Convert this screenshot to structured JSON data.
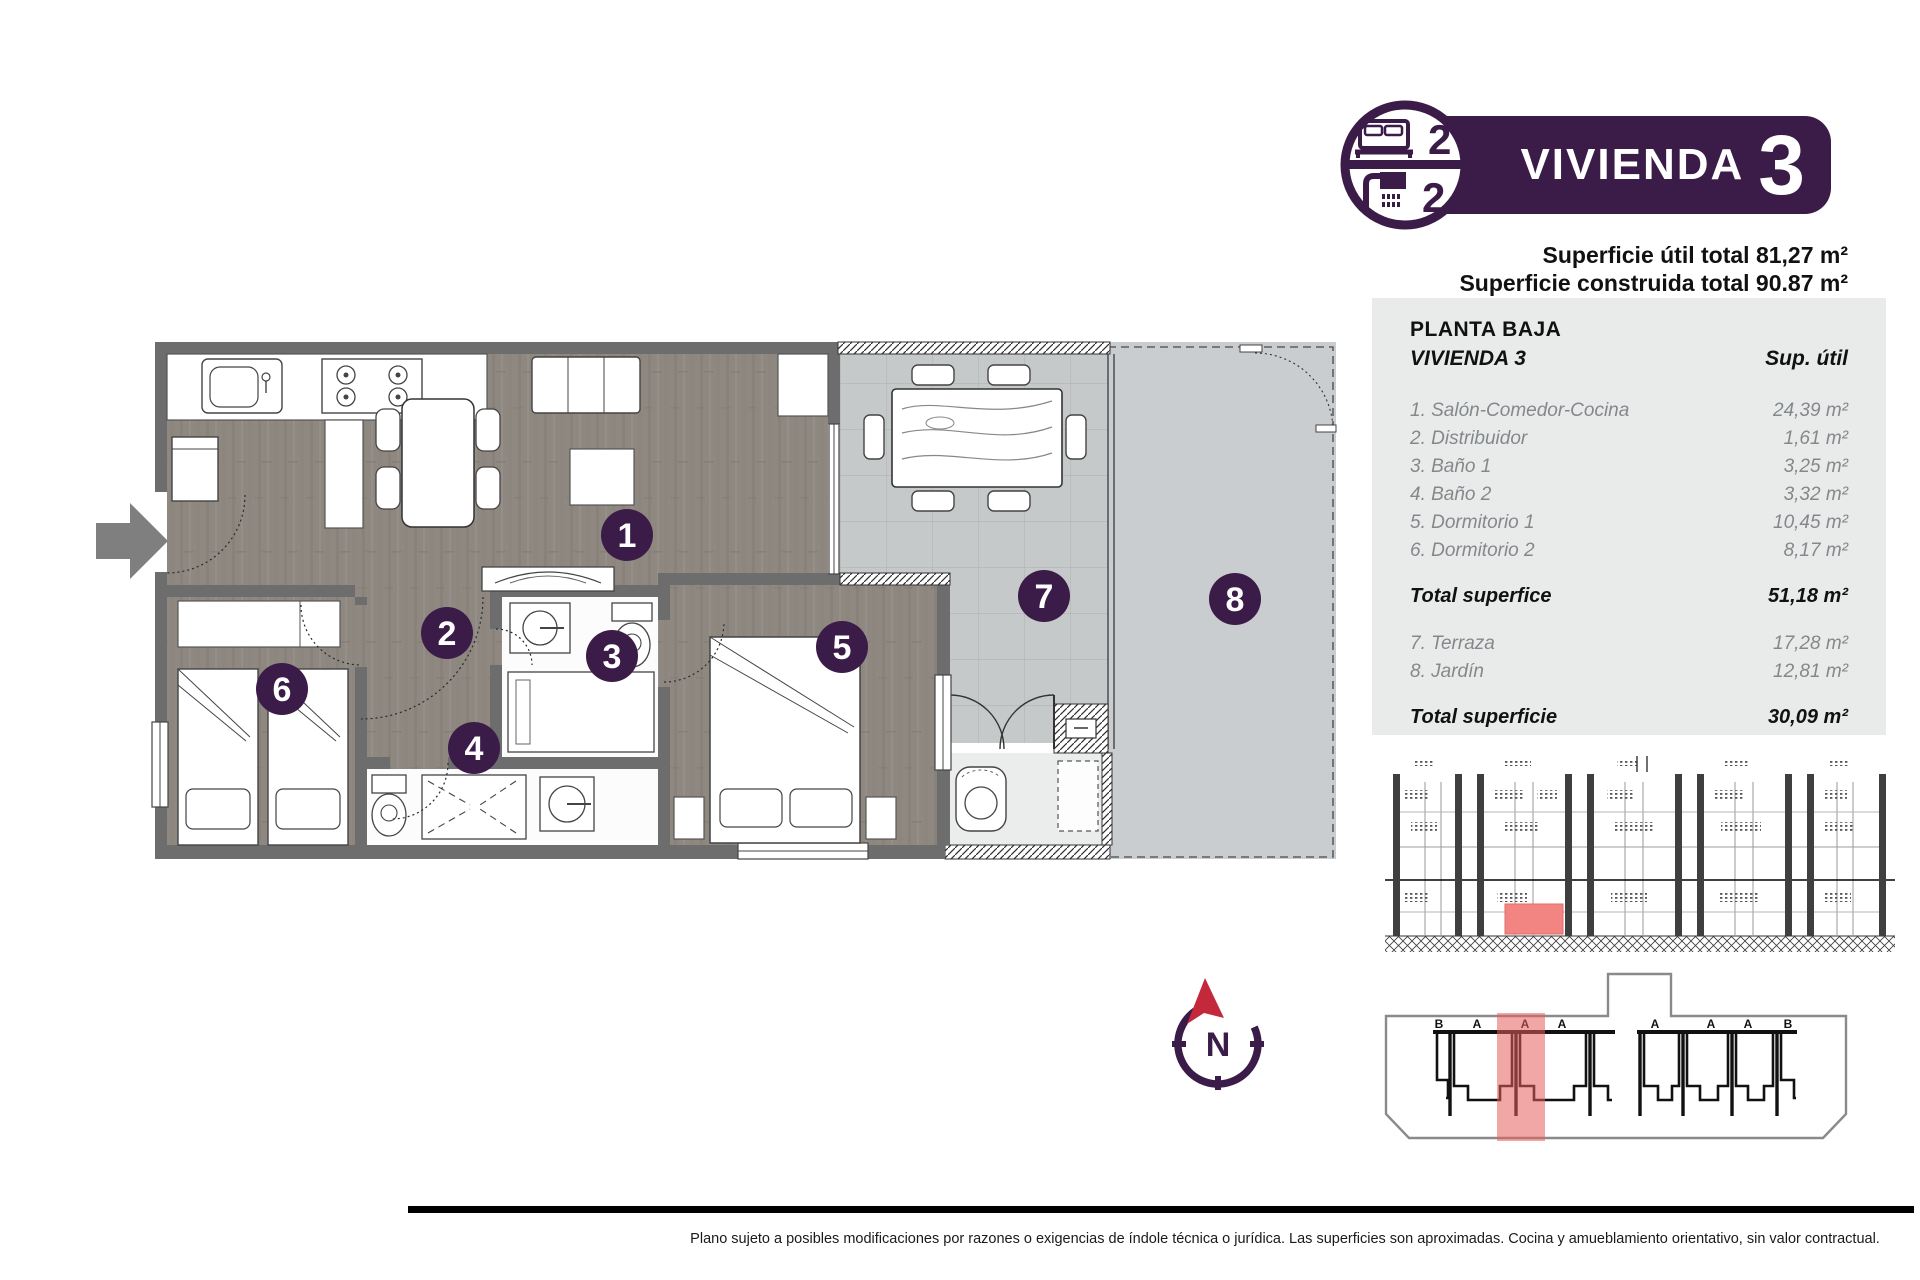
{
  "header": {
    "title": "VIVIENDA",
    "unit_number": "3",
    "badge": {
      "bedrooms": "2",
      "bathrooms": "2"
    },
    "superficie_util": "Superficie útil total 81,27 m²",
    "superficie_construida": "Superficie construida total 90.87 m²"
  },
  "table": {
    "floor_label": "PLANTA BAJA",
    "unit_label": "VIVIENDA 3",
    "col_header": "Sup. útil",
    "rooms": [
      {
        "label": "1. Salón-Comedor-Cocina",
        "area": "24,39 m²"
      },
      {
        "label": "2. Distribuidor",
        "area": "1,61 m²"
      },
      {
        "label": "3. Baño 1",
        "area": "3,25 m²"
      },
      {
        "label": "4. Baño 2",
        "area": "3,32 m²"
      },
      {
        "label": "5. Dormitorio 1",
        "area": "10,45 m²"
      },
      {
        "label": "6. Dormitorio 2",
        "area": "8,17 m²"
      }
    ],
    "total_interior": {
      "label": "Total superfice",
      "area": "51,18 m²"
    },
    "outdoor": [
      {
        "label": "7. Terraza",
        "area": "17,28 m²"
      },
      {
        "label": "8. Jardín",
        "area": "12,81 m²"
      }
    ],
    "total_outdoor": {
      "label": "Total superficie",
      "area": "30,09 m²"
    }
  },
  "plan": {
    "rooms": [
      {
        "number": "1"
      },
      {
        "number": "2"
      },
      {
        "number": "3"
      },
      {
        "number": "4"
      },
      {
        "number": "5"
      },
      {
        "number": "6"
      },
      {
        "number": "7"
      },
      {
        "number": "8"
      }
    ]
  },
  "site_plan": {
    "letters": [
      "B",
      "A",
      "A",
      "A",
      "A",
      "A",
      "A",
      "B"
    ]
  },
  "compass": {
    "label": "N"
  },
  "footer": {
    "disclaimer": "Plano sujeto a posibles modificaciones por razones o exigencias de índole técnica o jurídica. Las superficies son aproximadas. Cocina y amueblamiento orientativo, sin valor contractual."
  },
  "colors": {
    "brand_purple": "#3b1b47",
    "highlight_red": "#ef7b78",
    "wall_gray": "#6d6d6d",
    "wood_floor": "#8e8881",
    "terrace_tile": "#c6c9ca"
  }
}
